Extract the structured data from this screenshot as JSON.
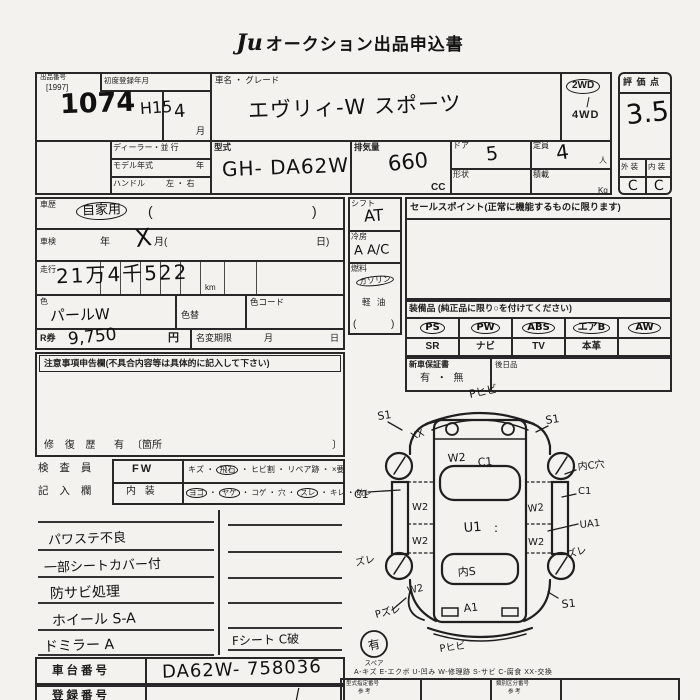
{
  "doc": {
    "logo": "Ju",
    "title": "オークション出品申込書"
  },
  "top": {
    "lot_label": "出品番号",
    "lot_code": "[1997]",
    "lot_number": "1074",
    "era": "H15",
    "first_reg_label": "初度登録年月",
    "first_reg_month": "4",
    "month_unit": "月",
    "car_name_label": "車名 ・ グレード",
    "car_name": "エヴリィ-W スポーツ",
    "drive_2wd": "2WD",
    "drive_check": "/",
    "drive_4wd": "4WD",
    "dealer_label": "ディーラー・並 行",
    "model_year_label": "モデル年式",
    "year_unit": "年",
    "handle_label": "ハンドル",
    "handle_lr": "左 ・ 右",
    "model_label": "型式",
    "model_value": "GH- DA62W",
    "disp_label": "排気量",
    "disp_value": "660",
    "disp_unit": "CC",
    "door_label": "ドア",
    "door_value": "5",
    "shape_label": "形状",
    "cap_label": "定員",
    "cap_value": "4",
    "cap_unit": "人",
    "load_label": "積載",
    "load_unit": "Kg"
  },
  "score": {
    "header": "評 価 点",
    "value": "3.5",
    "ext_label": "外 装",
    "int_label": "内 装",
    "ext_value": "C",
    "int_value": "C"
  },
  "mid": {
    "history_label": "車歴",
    "history_value": "自家用",
    "paren_open": "(",
    "paren_close": ")",
    "shaken_label": "車検",
    "year_unit": "年",
    "x_mark": "X",
    "month_open": "月(",
    "day_close": "日)",
    "mileage_label": "走行",
    "mileage_value": "21万4千522",
    "mileage_unit": "km",
    "color_label": "色",
    "color_value": "パールW",
    "color_change_label": "色替",
    "color_code_label": "色コード",
    "rticket_label": "R券",
    "rticket_value": "9,750",
    "yen_unit": "円",
    "namechange_label": "名変期限",
    "nc_month": "月",
    "nc_day": "日",
    "notice_header": "注意事項申告欄(不具合内容等は具体的に記入して下さい)",
    "repair_label": "修 復 歴",
    "repair_value": "有",
    "repair_open": "〔箇所",
    "repair_close": "〕"
  },
  "shift": {
    "shift_label": "シフト",
    "shift_value": "AT",
    "ac_label": "冷房",
    "ac_value": "A A/C",
    "fuel_label": "燃料",
    "fuel_gas": "ガソリン",
    "fuel_diesel": "軽 油",
    "paren_open": "(",
    "paren_close": ")"
  },
  "sales": {
    "header": "セールスポイント(正常に機能するものに限ります)",
    "equip_header": "装備品 (純正品に限り○を付けてください)",
    "row1": [
      "PS",
      "PW",
      "ABS",
      "エアB",
      "AW"
    ],
    "row2": [
      "SR",
      "ナビ",
      "TV",
      "本革"
    ],
    "warranty_label": "新車保証書",
    "warranty_value": "有 ・ 無",
    "later_label": "後日品"
  },
  "inspector": {
    "label_top": "検 査 員",
    "label_bottom": "記 入 欄",
    "sep": "・",
    "fw_label": "FW",
    "fw_items": [
      "キズ",
      "飛石",
      "ヒビ割",
      "リペア跡",
      "×要"
    ],
    "int_label": "内 装",
    "int_items": [
      "ヨゴ",
      "ヤケ",
      "コゲ",
      "穴",
      "スレ",
      "キレ",
      "破レ"
    ]
  },
  "notes": {
    "left": [
      "パワステ不良",
      "一部シートカバー付",
      "防サビ処理",
      "ホイール S-A",
      "ドミラー A"
    ],
    "right_last": "Fシート C破"
  },
  "chassis": {
    "chassis_label": "車台番号",
    "chassis_value": "DA62W- 758036",
    "reg_label": "登録番号",
    "reg_value": "/"
  },
  "diagram": {
    "legend": "A-キズ  E-エクボ  U-凹み  W-修理跡  S-サビ  C-腐食  XX-交換",
    "spare_mark": "有",
    "spare_label": "スペア",
    "ann": {
      "front_bumper": "Pヒビ",
      "fl_fender": "S1",
      "fl_xx": "XX",
      "front_w2": "W2",
      "front_c1": "C1",
      "fr_fender": "S1",
      "fr_wheel": "内C穴",
      "l_sill": "C1",
      "l_door_f": "W2",
      "l_door_r": "W2",
      "roof": "U1",
      "roof_marks": ":",
      "rear_glass": "内S",
      "rear_panel": "A1",
      "r_sill": "C1",
      "r_door_f": "W2",
      "r_door_r": "W2",
      "r_ua": "UA1",
      "l_zure": "ズレ",
      "r_zure": "ズレ",
      "l_rear_w2": "W2",
      "p_zure": "Pズレ",
      "rear_bumper": "Pヒビ",
      "rr_fender": "S1"
    }
  },
  "footer": {
    "box1_line1": "型式指定番号",
    "box1_line2": "参 考",
    "box2_line1": "類別区分番号",
    "box2_line2": "参 考"
  }
}
